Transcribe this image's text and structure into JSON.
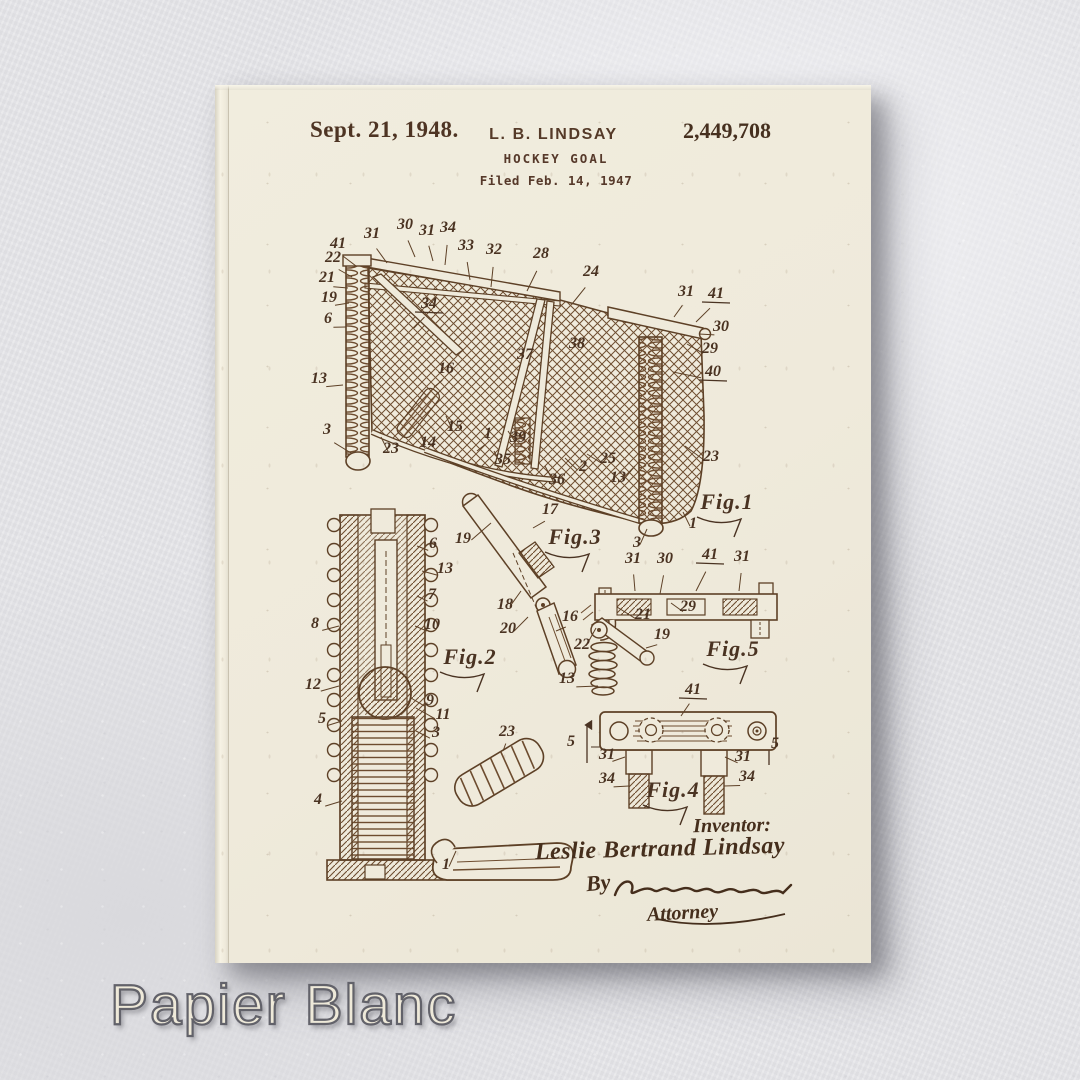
{
  "colors": {
    "wall": "#e7e7ea",
    "paper": "#efeadb",
    "ink_dark": "#4a3020",
    "ink_drawing": "#6d4c2f",
    "watermark_fill": "#eee9d9",
    "watermark_outline": "#62626a"
  },
  "header": {
    "date": "Sept. 21, 1948.",
    "inventor_name": "L. B. LINDSAY",
    "patent_number": "2,449,708",
    "title": "HOCKEY GOAL",
    "filed": "Filed Feb. 14, 1947"
  },
  "signature": {
    "inventor_label": "Inventor:",
    "inventor_full_name": "Leslie Bertrand Lindsay",
    "by_label": "By",
    "attorney_label": "Attorney"
  },
  "watermark": {
    "text": "Papier Blanc"
  },
  "drawing": {
    "callout_format": [
      "number",
      "x",
      "y",
      "leader_x",
      "leader_y",
      "underlined"
    ],
    "figure_labels": [
      {
        "text": "Fig.1",
        "x": 512,
        "y": 424
      },
      {
        "text": "Fig.2",
        "x": 255,
        "y": 579
      },
      {
        "text": "Fig.3",
        "x": 360,
        "y": 459
      },
      {
        "text": "Fig.4",
        "x": 458,
        "y": 712
      },
      {
        "text": "Fig.5",
        "x": 518,
        "y": 571
      }
    ],
    "callouts": [
      [
        "41",
        123,
        163,
        141,
        181,
        0
      ],
      [
        "31",
        157,
        153,
        172,
        178,
        0
      ],
      [
        "30",
        190,
        144,
        200,
        172,
        0
      ],
      [
        "31",
        212,
        150,
        218,
        176,
        0
      ],
      [
        "34",
        233,
        147,
        230,
        180,
        0
      ],
      [
        "33",
        251,
        165,
        255,
        195,
        0
      ],
      [
        "32",
        279,
        169,
        276,
        202,
        0
      ],
      [
        "28",
        326,
        173,
        312,
        206,
        0
      ],
      [
        "24",
        376,
        191,
        357,
        219,
        0
      ],
      [
        "22",
        118,
        177,
        137,
        192,
        0
      ],
      [
        "21",
        112,
        197,
        133,
        203,
        0
      ],
      [
        "19",
        114,
        217,
        134,
        218,
        0
      ],
      [
        "6",
        113,
        238,
        131,
        242,
        0
      ],
      [
        "13",
        104,
        298,
        128,
        300,
        0
      ],
      [
        "3",
        112,
        349,
        136,
        368,
        0
      ],
      [
        "34",
        214,
        223,
        199,
        243,
        1
      ],
      [
        "16",
        231,
        288,
        219,
        302,
        0
      ],
      [
        "37",
        310,
        274,
        0,
        0,
        0
      ],
      [
        "38",
        362,
        263,
        0,
        0,
        0
      ],
      [
        "31",
        471,
        211,
        459,
        232,
        0
      ],
      [
        "41",
        501,
        213,
        481,
        237,
        1
      ],
      [
        "30",
        506,
        246,
        484,
        249,
        0
      ],
      [
        "29",
        495,
        268,
        472,
        259,
        0
      ],
      [
        "40",
        498,
        291,
        458,
        287,
        1
      ],
      [
        "23",
        176,
        368,
        166,
        352,
        0
      ],
      [
        "14",
        213,
        362,
        204,
        346,
        0
      ],
      [
        "15",
        240,
        346,
        231,
        331,
        0
      ],
      [
        "1",
        273,
        353,
        262,
        366,
        0
      ],
      [
        "39",
        303,
        357,
        293,
        346,
        0
      ],
      [
        "35",
        288,
        379,
        279,
        366,
        0
      ],
      [
        "36",
        342,
        399,
        330,
        381,
        0
      ],
      [
        "2",
        368,
        386,
        350,
        373,
        0
      ],
      [
        "25",
        393,
        378,
        372,
        369,
        0
      ],
      [
        "13",
        403,
        397,
        420,
        381,
        0
      ],
      [
        "23",
        496,
        376,
        470,
        361,
        0
      ],
      [
        "3",
        422,
        462,
        432,
        444,
        0
      ],
      [
        "1",
        478,
        443,
        468,
        427,
        0
      ],
      [
        "19",
        248,
        458,
        276,
        438,
        0
      ],
      [
        "17",
        335,
        429,
        318,
        443,
        0
      ],
      [
        "18",
        290,
        524,
        306,
        506,
        0
      ],
      [
        "20",
        293,
        548,
        313,
        532,
        0
      ],
      [
        "16",
        355,
        536,
        341,
        546,
        0
      ],
      [
        "6",
        218,
        463,
        202,
        461,
        0
      ],
      [
        "13",
        230,
        488,
        207,
        486,
        0
      ],
      [
        "7",
        217,
        514,
        202,
        511,
        0
      ],
      [
        "10",
        217,
        544,
        200,
        541,
        0
      ],
      [
        "8",
        100,
        543,
        124,
        541,
        0
      ],
      [
        "12",
        98,
        604,
        124,
        601,
        0
      ],
      [
        "9",
        215,
        620,
        196,
        613,
        0
      ],
      [
        "11",
        228,
        634,
        201,
        623,
        0
      ],
      [
        "5",
        107,
        638,
        127,
        636,
        0
      ],
      [
        "3",
        221,
        652,
        201,
        646,
        0
      ],
      [
        "4",
        103,
        719,
        127,
        716,
        0
      ],
      [
        "23",
        292,
        651,
        288,
        666,
        0
      ],
      [
        "1",
        231,
        784,
        241,
        766,
        0
      ],
      [
        "31",
        418,
        478,
        420,
        506,
        0
      ],
      [
        "30",
        450,
        478,
        445,
        509,
        0
      ],
      [
        "41",
        495,
        474,
        481,
        506,
        1
      ],
      [
        "31",
        527,
        476,
        524,
        506,
        0
      ],
      [
        "29",
        473,
        526,
        456,
        518,
        0
      ],
      [
        "21",
        428,
        534,
        402,
        522,
        0
      ],
      [
        "19",
        447,
        554,
        431,
        563,
        0
      ],
      [
        "22",
        367,
        564,
        381,
        543,
        0
      ],
      [
        "13",
        352,
        598,
        383,
        601,
        0
      ],
      [
        "41",
        478,
        609,
        466,
        631,
        1
      ],
      [
        "5",
        356,
        661,
        0,
        0,
        0
      ],
      [
        "5",
        560,
        663,
        0,
        0,
        0
      ],
      [
        "31",
        392,
        674,
        410,
        672,
        0
      ],
      [
        "31",
        528,
        676,
        510,
        672,
        0
      ],
      [
        "34",
        392,
        698,
        414,
        701,
        0
      ],
      [
        "34",
        532,
        696,
        509,
        701,
        0
      ]
    ]
  }
}
